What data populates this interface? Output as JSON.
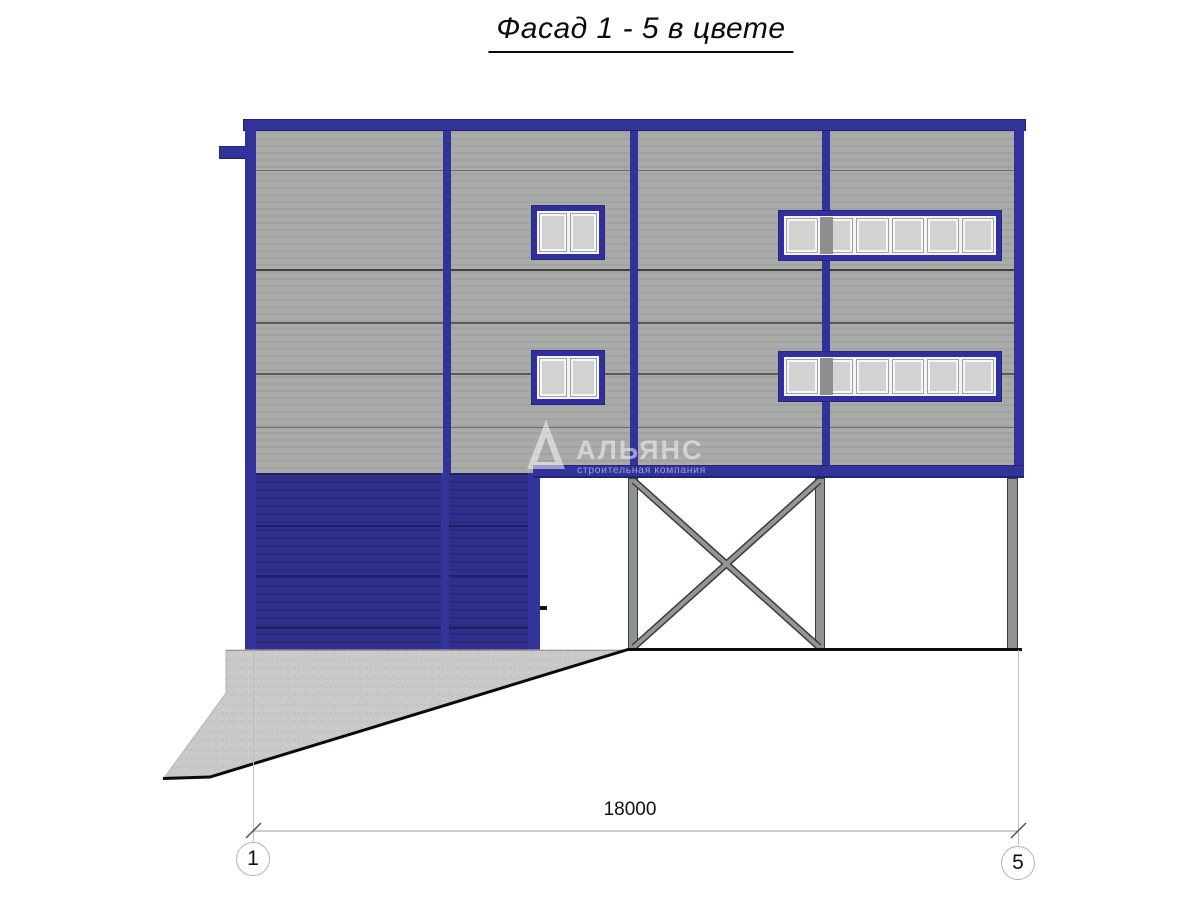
{
  "title": "Фасад 1 - 5 в цвете",
  "watermark": {
    "name": "АЛЬЯНС",
    "tagline": "строительная компания"
  },
  "dimension": {
    "value": "18000"
  },
  "grid_markers": {
    "left": "1",
    "right": "5"
  },
  "colors": {
    "frame_blue": "#32329b",
    "gate_navy": "#2f2f8c",
    "panel_gray": "#a8aaa7",
    "column_gray": "#8f938f",
    "concrete_gray": "#cac9c7",
    "glass_gray": "#d2d2d2"
  }
}
